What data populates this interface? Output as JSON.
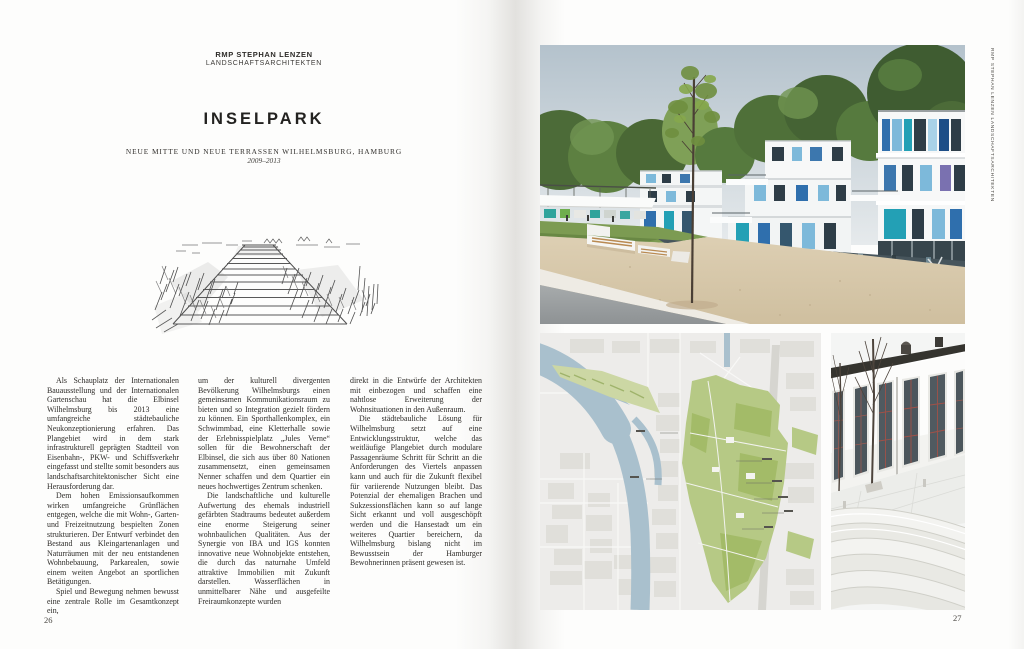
{
  "left_page": {
    "studio_line1": "RMP STEPHAN LENZEN",
    "studio_line2": "LANDSCHAFTSARCHITEKTEN",
    "title": "INSELPARK",
    "subtitle": "NEUE MITTE UND NEUE TERRASSEN WILHELMSBURG, HAMBURG",
    "years": "2009–2013",
    "page_number": "26",
    "columns": {
      "col1": {
        "p1": "Als Schauplatz der Internationalen Bauausstellung und der Internationalen Gartenschau hat die Elbinsel Wilhelmsburg bis 2013 eine umfangreiche städtebauliche Neukonzeptionierung erfahren. Das Plangebiet wird in dem stark infrastrukturell geprägten Stadtteil von Eisenbahn-, PKW- und Schiffsverkehr eingefasst und stellte somit besonders aus landschaftsarchitektonischer Sicht eine Herausforderung dar.",
        "p2": "Dem hohen Emissionsaufkommen wirken umfangreiche Grünflächen entgegen, welche die mit Wohn-, Garten- und Freizeitnutzung bespielten Zonen strukturieren. Der Entwurf verbindet den Bestand aus Kleingartenanlagen und Naturräumen mit der neu entstandenen Wohnbebauung, Parkarealen, sowie einem weiten Angebot an sportlichen Betätigungen.",
        "p3": "Spiel und Bewegung nehmen bewusst eine zentrale Rolle im Gesamtkonzept ein,"
      },
      "col2": {
        "p1": "um der kulturell divergenten Bevölkerung Wilhelmsburgs einen gemeinsamen Kommunikationsraum zu bieten und so Integration gezielt fördern zu können. Ein Sporthallenkomplex, ein Schwimmbad, eine Kletterhalle sowie der Erlebnisspielplatz „Jules Verne“ sollen für die Bewohnerschaft der Elbinsel, die sich aus über 80 Nationen zusammensetzt, einen gemeinsamen Nenner schaffen und dem Quartier ein neues hochwertiges Zentrum schenken.",
        "p2": "Die landschaftliche und kulturelle Aufwertung des ehemals industriell gefärbten Stadtraums bedeutet außerdem eine enorme Steigerung seiner wohnbaulichen Qualitäten. Aus der Synergie von IBA und IGS konnten innovative neue Wohnobjekte entstehen, die durch das naturnahe Umfeld attraktive Immobilien mit Zukunft darstellen. Wasserflächen in unmittelbarer Nähe und ausgefeilte Freiraumkonzepte wurden"
      },
      "col3": {
        "p1": "direkt in die Entwürfe der Architekten mit einbezogen und schaffen eine nahtlose Erweiterung der Wohnsituationen in den Außenraum.",
        "p2": "Die städtebauliche Lösung für Wilhelmsburg setzt auf eine Entwicklungsstruktur, welche das weitläufige Plangebiet durch modulare Passagenräume Schritt für Schritt an die Anforderungen des Viertels anpassen kann und auch für die Zukunft flexibel für variierende Nutzungen bleibt. Das Potenzial der ehemaligen Brachen und Sukzessionsflächen kann so auf lange Sicht erkannt und voll ausgeschöpft werden und die Hansestadt um ein weiteres Quartier bereichern, da Wilhelmsburg bislang nicht im Bewusstsein der Hamburger Bewohnerinnen präsent gewesen ist."
      }
    }
  },
  "right_page": {
    "side_label": "RMP STEPHAN LENZEN LANDSCHAFTSARCHITEKTEN",
    "page_number": "27"
  },
  "colors": {
    "panel_blue": "#2f6fad",
    "panel_light_blue": "#7db9da",
    "panel_teal": "#23a0b5",
    "map_green": "#b6c985",
    "map_water": "#a9c0cd",
    "sand": "#d8c9ac"
  }
}
